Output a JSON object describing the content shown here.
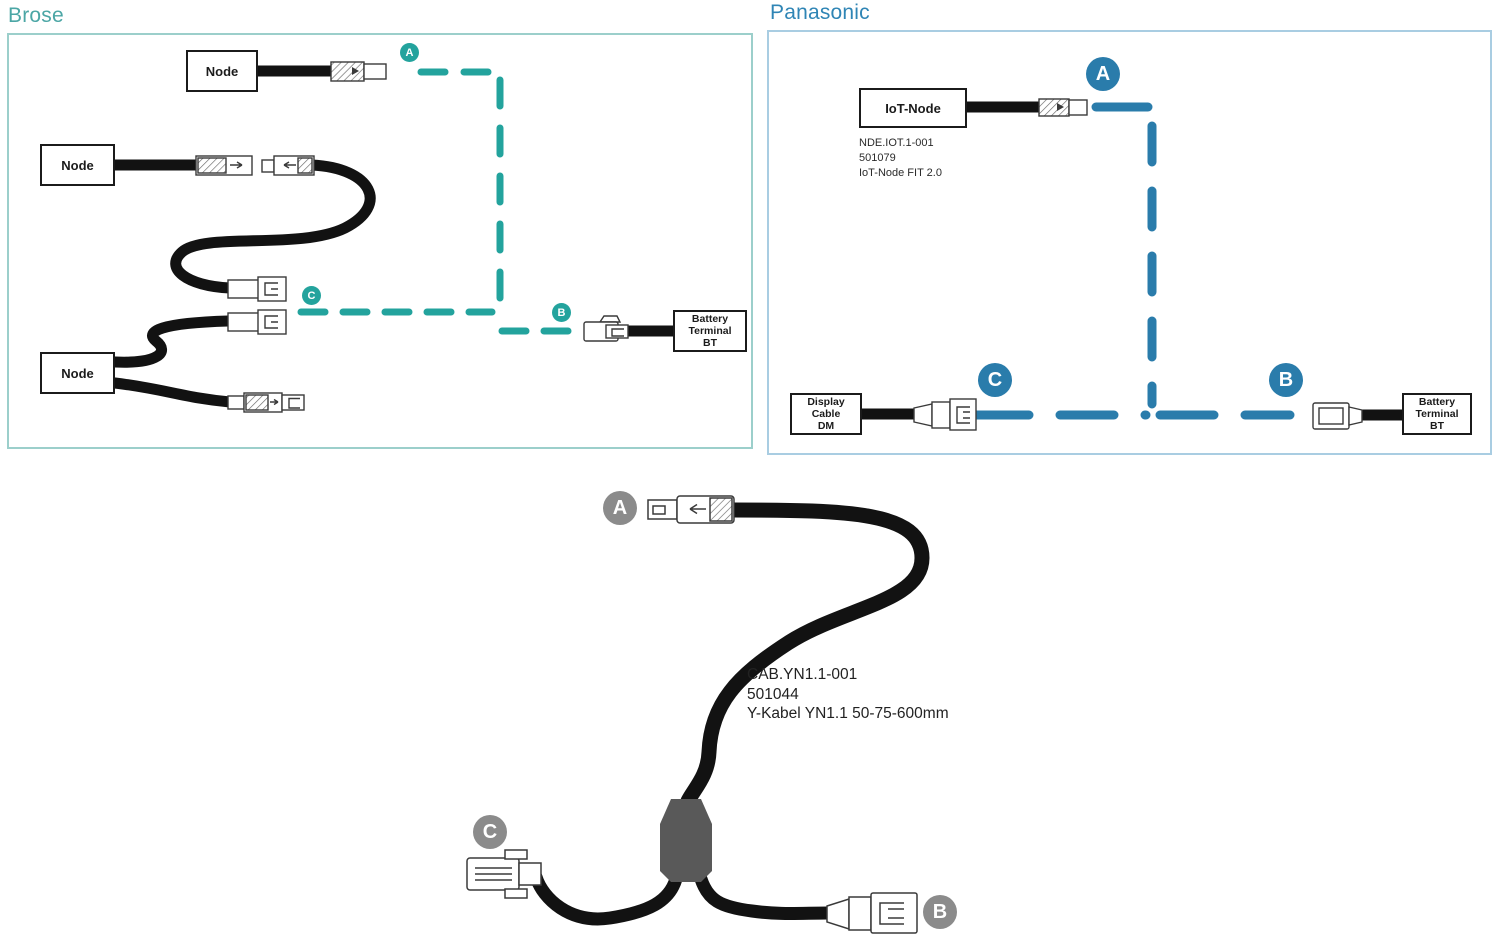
{
  "colors": {
    "brose_accent": "#23a39d",
    "brose_border": "#9ccfcb",
    "brose_title": "#4ba6a5",
    "panasonic_accent": "#2a7cab",
    "panasonic_border": "#a9cde2",
    "panasonic_title": "#2f85b5",
    "gray_marker": "#8b8b8b",
    "splitter_gray": "#595959",
    "cable_black": "#121212"
  },
  "brose": {
    "title": "Brose",
    "node_labels": [
      "Node",
      "Node",
      "Node"
    ],
    "battery_lines": [
      "Battery",
      "Terminal",
      "BT"
    ],
    "markers": {
      "a": "A",
      "b": "B",
      "c": "C"
    }
  },
  "panasonic": {
    "title": "Panasonic",
    "iot_label": "IoT-Node",
    "part_lines": [
      "NDE.IOT.1-001",
      "501079",
      "IoT-Node FIT 2.0"
    ],
    "display_lines": [
      "Display",
      "Cable",
      "DM"
    ],
    "battery_lines": [
      "Battery",
      "Terminal",
      "BT"
    ],
    "markers": {
      "a": "A",
      "b": "B",
      "c": "C"
    }
  },
  "ycable": {
    "part_lines": [
      "CAB.YN1.1-001",
      "501044",
      "Y-Kabel YN1.1 50-75-600mm"
    ],
    "markers": {
      "a": "A",
      "b": "B",
      "c": "C"
    }
  }
}
